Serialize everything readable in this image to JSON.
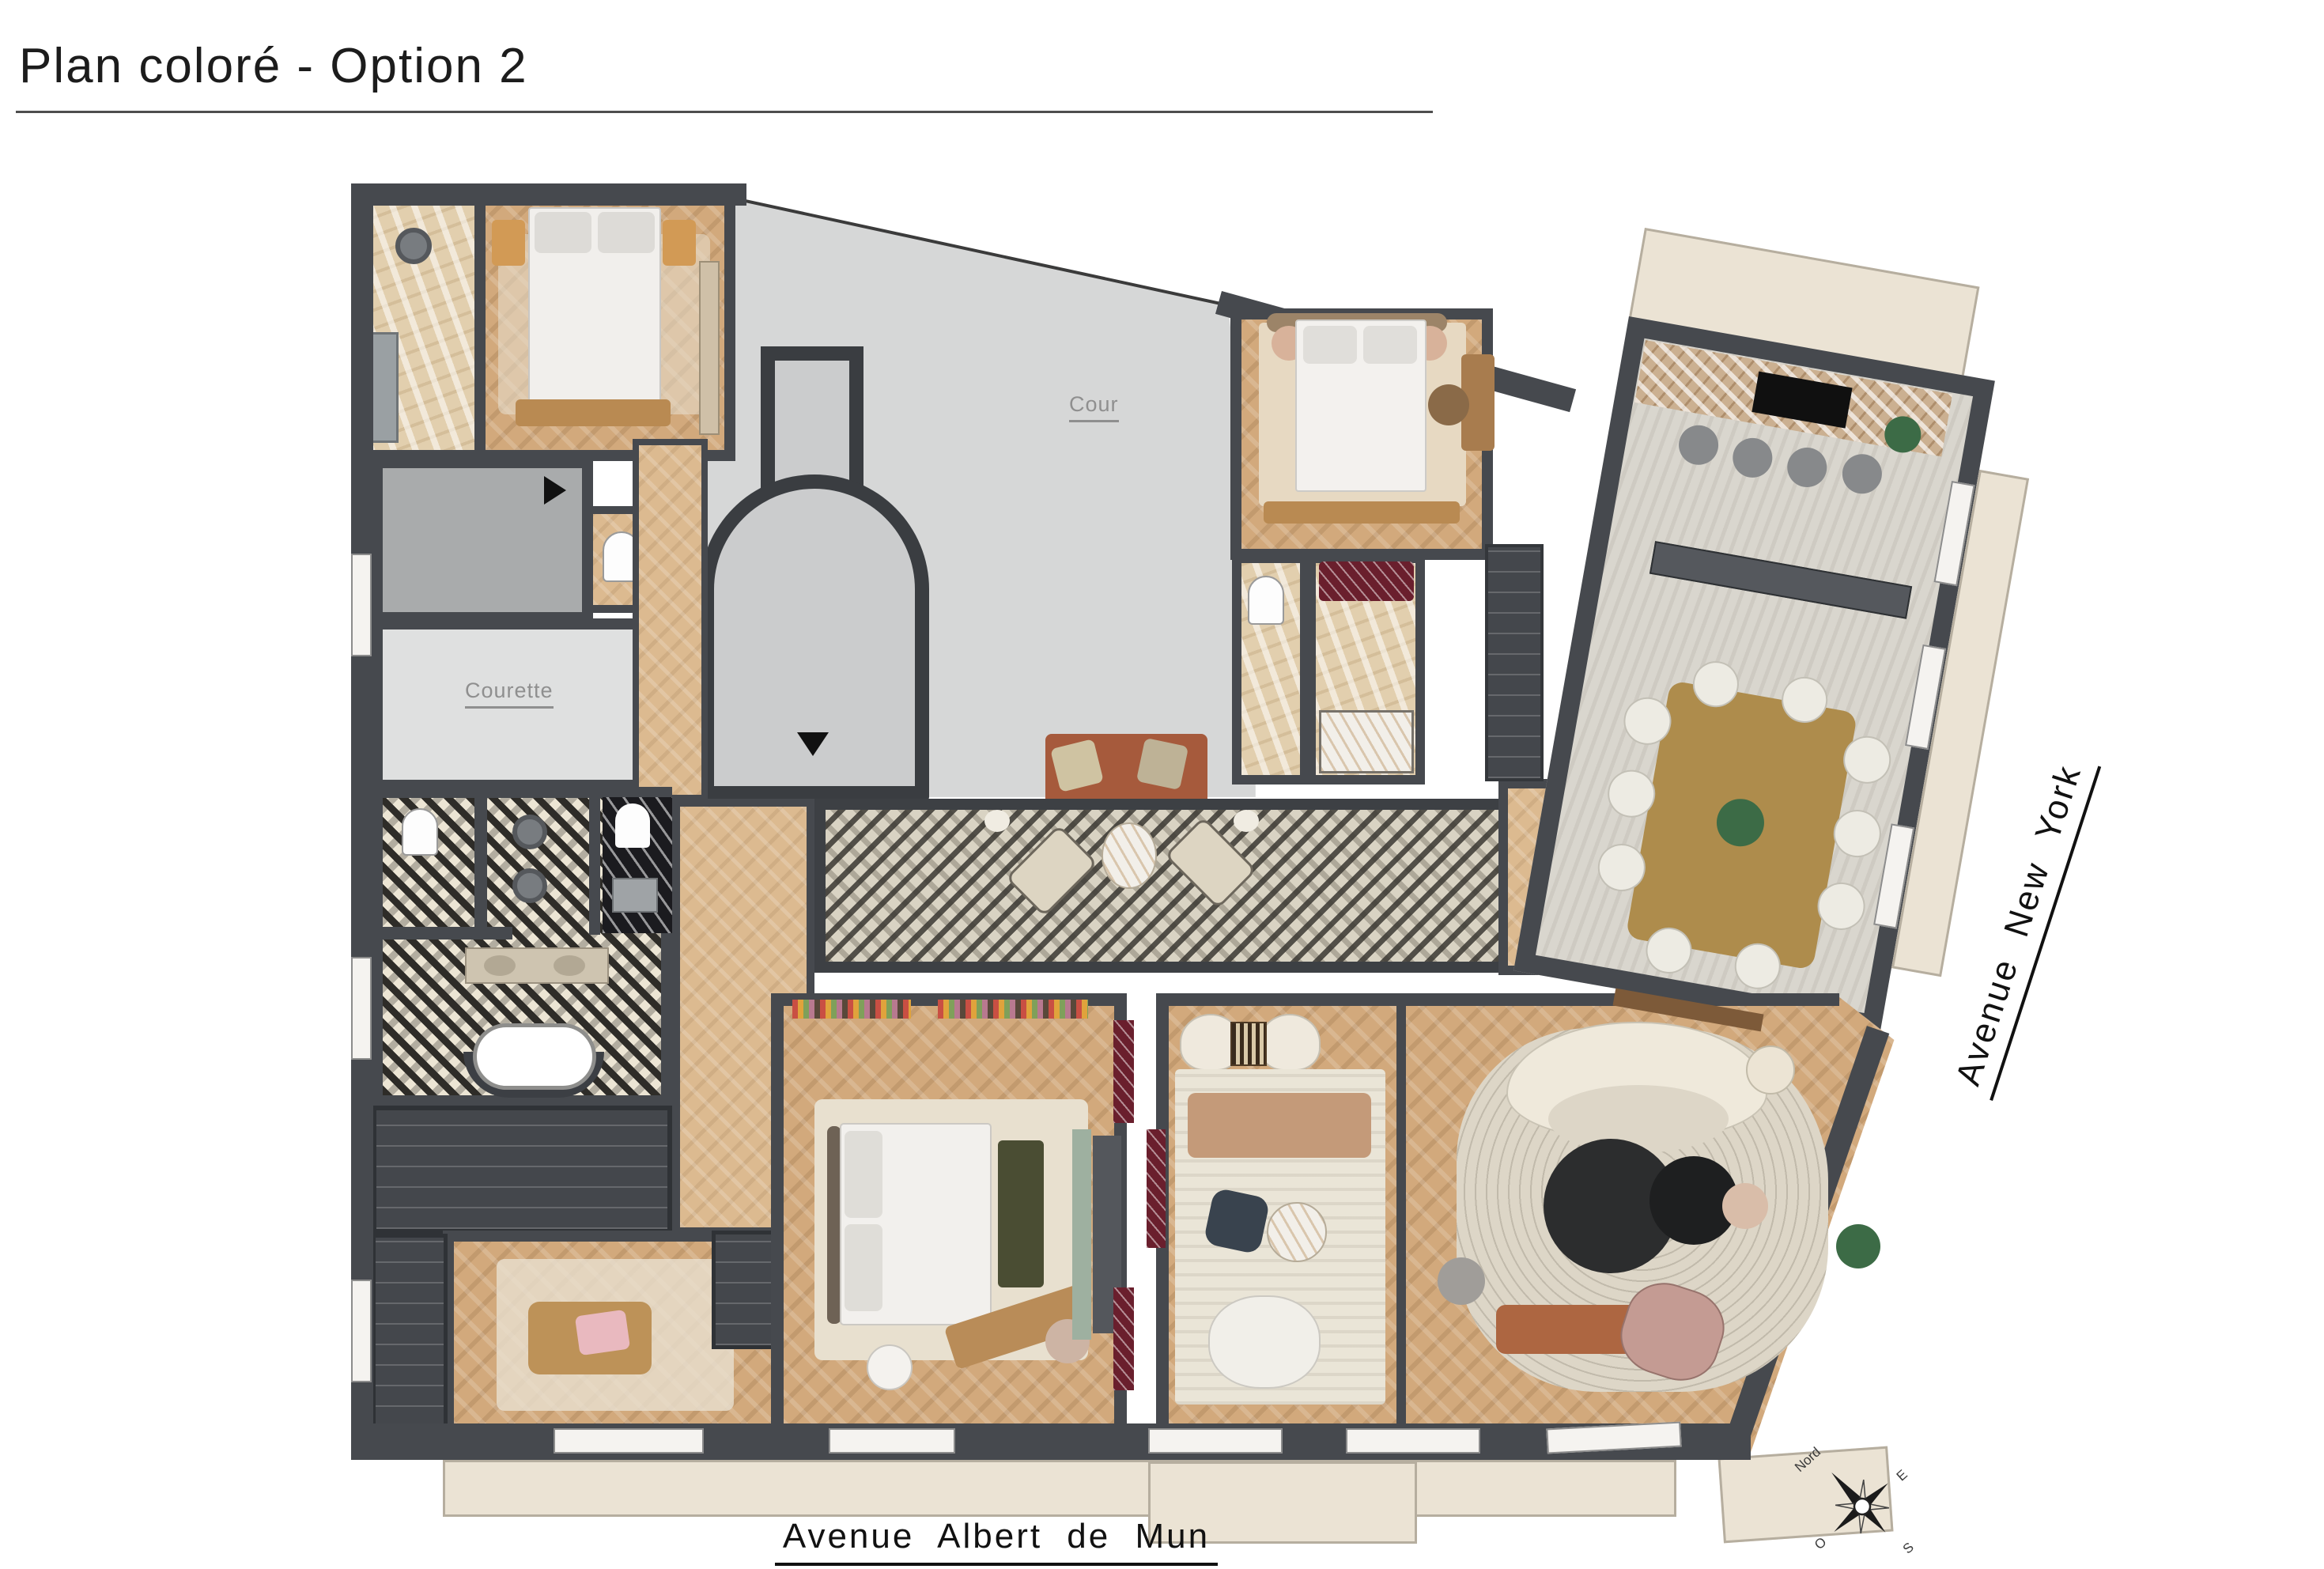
{
  "title": "Plan coloré - Option 2",
  "plan_labels": {
    "courtyard": "Cour",
    "small_courtyard": "Courette"
  },
  "streets": {
    "right": "Avenue New York",
    "bottom": "Avenue Albert de Mun"
  },
  "compass": {
    "north": "Nord",
    "east": "E",
    "west": "O",
    "south": "S"
  },
  "icons": [
    "compass-rose-icon",
    "entrance-arrow-icon",
    "shower-head-icon"
  ],
  "colors": {
    "wall": "#46494e",
    "wood_floor": "#d2a97c",
    "light_wood_floor": "#dcba90",
    "stone_floor": "#d9d6ce",
    "beige_marble": "#e2cfae",
    "courtyard_gray": "#d6d7d7",
    "cube_tile_dark": "#3a3832",
    "cube_tile_light": "#d9d3c3",
    "terracotta_bench": "#a65a3c",
    "gold_table": "#ae8c4c",
    "green_bench": "#4a4d33",
    "cream_rug": "#e8e0cf",
    "black_marble": "#1b1b1f",
    "red_marble": "#6a1f2d"
  }
}
